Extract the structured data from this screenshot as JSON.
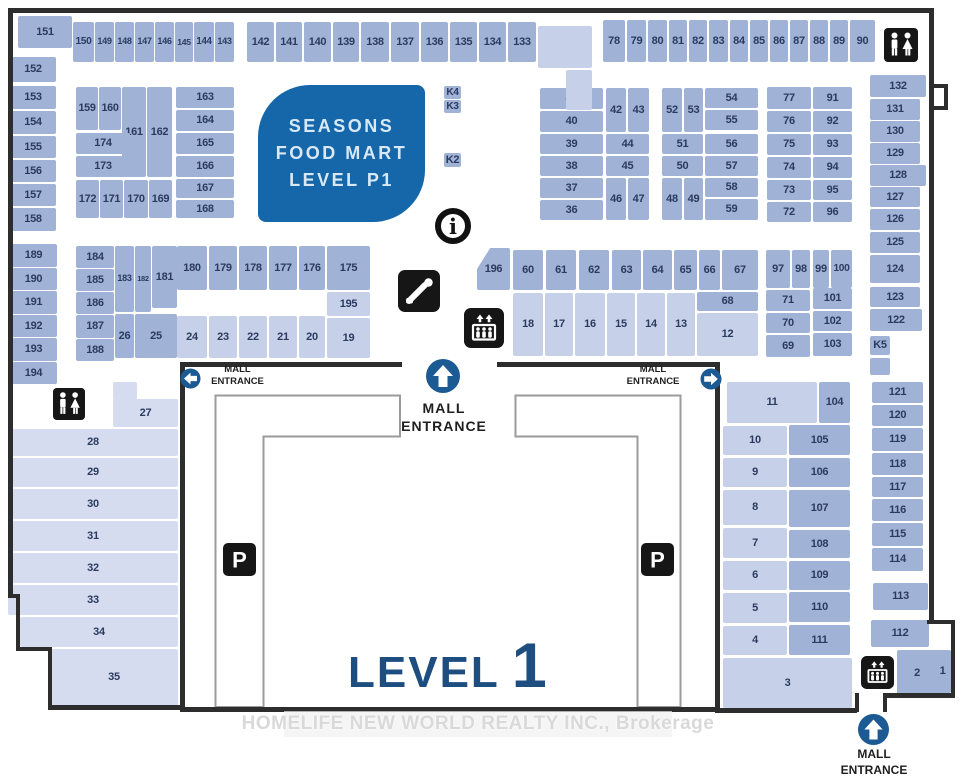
{
  "title": {
    "level_word": "LEVEL",
    "level_number": "1"
  },
  "food_mart": {
    "lines": [
      "SEASONS",
      "FOOD MART",
      "LEVEL P1"
    ]
  },
  "watermark_text": "HOMELIFE NEW WORLD REALTY INC., Brokerage",
  "entrances": {
    "left": {
      "line1": "MALL",
      "line2": "ENTRANCE",
      "arrow": "left"
    },
    "center": {
      "line1": "MALL",
      "line2": "ENTRANCE",
      "arrow": "up"
    },
    "right": {
      "line1": "MALL",
      "line2": "ENTRANCE",
      "arrow": "right"
    },
    "bottom": {
      "line1": "MALL",
      "line2": "ENTRANCE",
      "arrow": "up"
    }
  },
  "icons": [
    "restroom-icon",
    "info-icon",
    "escalator-icon",
    "elevator-icon",
    "parking-icon",
    "entrance-arrow-up-icon",
    "entrance-arrow-left-icon",
    "entrance-arrow-right-icon"
  ],
  "colors": {
    "unit_medium": "#a0b2d6",
    "unit_light": "#c7d0e9",
    "unit_lighter": "#d6dcf0",
    "wall": "#2d2d2d",
    "number_text": "#2b3b5f",
    "food_mart_bg": "#1567a9",
    "entrance_blue": "#1c5a94",
    "level_text": "#1d4e7f",
    "icon_black": "#161616"
  },
  "units": [
    [
      "151",
      18,
      16,
      54,
      32,
      "a"
    ],
    [
      "150",
      73,
      22,
      21,
      40,
      "a"
    ],
    [
      "149",
      95,
      22,
      19,
      40,
      "a"
    ],
    [
      "148",
      115,
      22,
      19,
      40,
      "a"
    ],
    [
      "147",
      135,
      22,
      19,
      40,
      "a"
    ],
    [
      "146",
      155,
      22,
      19,
      40,
      "a"
    ],
    [
      "145",
      175,
      22,
      18,
      40,
      "a"
    ],
    [
      "144",
      194,
      22,
      20,
      40,
      "a"
    ],
    [
      "143",
      215,
      22,
      19,
      40,
      "a"
    ],
    [
      "152",
      10,
      57,
      46,
      25,
      "a"
    ],
    [
      "153",
      10,
      86,
      46,
      23,
      "a"
    ],
    [
      "154",
      10,
      111,
      46,
      23,
      "a"
    ],
    [
      "155",
      10,
      136,
      46,
      22,
      "a"
    ],
    [
      "156",
      10,
      160,
      46,
      22,
      "a"
    ],
    [
      "157",
      10,
      184,
      46,
      22,
      "a"
    ],
    [
      "158",
      10,
      208,
      46,
      23,
      "a"
    ],
    [
      "159",
      76,
      87,
      22,
      43,
      "a"
    ],
    [
      "160",
      99,
      87,
      22,
      43,
      "a"
    ],
    [
      "161",
      122,
      87,
      24,
      90,
      "a"
    ],
    [
      "162",
      147,
      87,
      25,
      90,
      "a"
    ],
    [
      "174",
      76,
      133,
      54,
      21,
      "a"
    ],
    [
      "173",
      76,
      156,
      54,
      21,
      "a"
    ],
    [
      "172",
      76,
      180,
      23,
      38,
      "a"
    ],
    [
      "171",
      100,
      180,
      23,
      38,
      "a"
    ],
    [
      "170",
      124,
      180,
      24,
      38,
      "a"
    ],
    [
      "169",
      149,
      180,
      23,
      38,
      "a"
    ],
    [
      "163",
      176,
      87,
      58,
      21,
      "a"
    ],
    [
      "164",
      176,
      110,
      58,
      21,
      "a"
    ],
    [
      "165",
      176,
      133,
      58,
      21,
      "a"
    ],
    [
      "166",
      176,
      156,
      58,
      21,
      "a"
    ],
    [
      "167",
      176,
      179,
      58,
      19,
      "a"
    ],
    [
      "168",
      176,
      200,
      58,
      18,
      "a"
    ],
    [
      "142",
      247,
      22,
      27,
      40,
      "a"
    ],
    [
      "141",
      276,
      22,
      26,
      40,
      "a"
    ],
    [
      "140",
      304,
      22,
      27,
      40,
      "a"
    ],
    [
      "139",
      333,
      22,
      26,
      40,
      "a"
    ],
    [
      "138",
      361,
      22,
      28,
      40,
      "a"
    ],
    [
      "137",
      391,
      22,
      28,
      40,
      "a"
    ],
    [
      "136",
      421,
      22,
      27,
      40,
      "a"
    ],
    [
      "135",
      450,
      22,
      27,
      40,
      "a"
    ],
    [
      "134",
      479,
      22,
      27,
      40,
      "a"
    ],
    [
      "133",
      508,
      22,
      28,
      40,
      "a"
    ],
    [
      "K4",
      444,
      86,
      17,
      13,
      "a"
    ],
    [
      "K3",
      444,
      100,
      17,
      13,
      "a"
    ],
    [
      "K2",
      444,
      153,
      17,
      14,
      "a"
    ],
    [
      "78",
      603,
      20,
      22,
      42,
      "a"
    ],
    [
      "79",
      627,
      20,
      19,
      42,
      "a"
    ],
    [
      "80",
      648,
      20,
      19,
      42,
      "a"
    ],
    [
      "81",
      669,
      20,
      18,
      42,
      "a"
    ],
    [
      "82",
      689,
      20,
      18,
      42,
      "a"
    ],
    [
      "83",
      709,
      20,
      19,
      42,
      "a"
    ],
    [
      "84",
      730,
      20,
      18,
      42,
      "a"
    ],
    [
      "85",
      750,
      20,
      18,
      42,
      "a"
    ],
    [
      "86",
      770,
      20,
      18,
      42,
      "a"
    ],
    [
      "87",
      790,
      20,
      18,
      42,
      "a"
    ],
    [
      "88",
      810,
      20,
      18,
      42,
      "a"
    ],
    [
      "89",
      830,
      20,
      18,
      42,
      "a"
    ],
    [
      "90",
      850,
      20,
      25,
      42,
      "a"
    ],
    [
      "41",
      540,
      88,
      63,
      21,
      "a"
    ],
    [
      "40",
      540,
      111,
      63,
      21,
      "a"
    ],
    [
      "39",
      540,
      134,
      63,
      20,
      "a"
    ],
    [
      "38",
      540,
      156,
      63,
      20,
      "a"
    ],
    [
      "37",
      540,
      178,
      63,
      20,
      "a"
    ],
    [
      "36",
      540,
      200,
      63,
      20,
      "a"
    ],
    [
      "42",
      606,
      88,
      20,
      44,
      "a"
    ],
    [
      "43",
      628,
      88,
      21,
      44,
      "a"
    ],
    [
      "44",
      606,
      134,
      43,
      20,
      "a"
    ],
    [
      "45",
      606,
      156,
      43,
      20,
      "a"
    ],
    [
      "46",
      606,
      178,
      20,
      42,
      "a"
    ],
    [
      "47",
      628,
      178,
      21,
      42,
      "a"
    ],
    [
      "52",
      662,
      88,
      20,
      44,
      "a"
    ],
    [
      "53",
      684,
      88,
      19,
      44,
      "a"
    ],
    [
      "54",
      705,
      88,
      53,
      20,
      "a"
    ],
    [
      "55",
      705,
      110,
      53,
      20,
      "a"
    ],
    [
      "51",
      662,
      134,
      41,
      20,
      "a"
    ],
    [
      "56",
      705,
      134,
      53,
      20,
      "a"
    ],
    [
      "50",
      662,
      156,
      41,
      20,
      "a"
    ],
    [
      "57",
      705,
      156,
      53,
      20,
      "a"
    ],
    [
      "48",
      662,
      178,
      20,
      42,
      "a"
    ],
    [
      "49",
      684,
      178,
      19,
      42,
      "a"
    ],
    [
      "58",
      705,
      178,
      53,
      19,
      "a"
    ],
    [
      "59",
      705,
      199,
      53,
      21,
      "a"
    ],
    [
      "77",
      767,
      87,
      44,
      22,
      "a"
    ],
    [
      "76",
      767,
      111,
      44,
      21,
      "a"
    ],
    [
      "75",
      767,
      134,
      44,
      21,
      "a"
    ],
    [
      "74",
      767,
      157,
      44,
      21,
      "a"
    ],
    [
      "73",
      767,
      180,
      44,
      20,
      "a"
    ],
    [
      "72",
      767,
      202,
      44,
      20,
      "a"
    ],
    [
      "91",
      813,
      87,
      39,
      22,
      "a"
    ],
    [
      "92",
      813,
      111,
      39,
      21,
      "a"
    ],
    [
      "93",
      813,
      134,
      39,
      21,
      "a"
    ],
    [
      "94",
      813,
      157,
      39,
      21,
      "a"
    ],
    [
      "95",
      813,
      180,
      39,
      20,
      "a"
    ],
    [
      "96",
      813,
      202,
      39,
      20,
      "a"
    ],
    [
      "132",
      870,
      75,
      56,
      22,
      "a"
    ],
    [
      "131",
      870,
      99,
      50,
      21,
      "a"
    ],
    [
      "130",
      870,
      121,
      50,
      21,
      "a"
    ],
    [
      "129",
      870,
      143,
      50,
      21,
      "a"
    ],
    [
      "128",
      870,
      165,
      56,
      21,
      "a"
    ],
    [
      "127",
      870,
      187,
      50,
      20,
      "a"
    ],
    [
      "126",
      870,
      209,
      50,
      21,
      "a"
    ],
    [
      "125",
      870,
      232,
      50,
      21,
      "a"
    ],
    [
      "124",
      870,
      255,
      50,
      28,
      "a"
    ],
    [
      "123",
      870,
      287,
      50,
      20,
      "a"
    ],
    [
      "122",
      870,
      309,
      52,
      22,
      "a"
    ],
    [
      "K5",
      870,
      336,
      20,
      19,
      "a"
    ],
    [
      "196",
      477,
      248,
      33,
      42,
      "a"
    ],
    [
      "60",
      513,
      250,
      30,
      40,
      "a"
    ],
    [
      "61",
      546,
      250,
      30,
      40,
      "a"
    ],
    [
      "62",
      579,
      250,
      30,
      40,
      "a"
    ],
    [
      "63",
      612,
      250,
      29,
      40,
      "a"
    ],
    [
      "64",
      643,
      250,
      29,
      40,
      "a"
    ],
    [
      "65",
      674,
      250,
      23,
      40,
      "a"
    ],
    [
      "66",
      699,
      250,
      21,
      40,
      "a"
    ],
    [
      "67",
      722,
      250,
      36,
      40,
      "a"
    ],
    [
      "68",
      697,
      292,
      61,
      19,
      "a"
    ],
    [
      "18",
      513,
      293,
      30,
      63,
      "b"
    ],
    [
      "17",
      545,
      293,
      28,
      63,
      "b"
    ],
    [
      "16",
      575,
      293,
      30,
      63,
      "b"
    ],
    [
      "15",
      607,
      293,
      28,
      63,
      "b"
    ],
    [
      "14",
      637,
      293,
      28,
      63,
      "b"
    ],
    [
      "13",
      667,
      293,
      28,
      63,
      "b"
    ],
    [
      "12",
      697,
      313,
      61,
      43,
      "b"
    ],
    [
      "189",
      10,
      244,
      47,
      23,
      "a"
    ],
    [
      "190",
      10,
      268,
      47,
      22,
      "a"
    ],
    [
      "191",
      10,
      291,
      47,
      23,
      "a"
    ],
    [
      "192",
      10,
      315,
      47,
      22,
      "a"
    ],
    [
      "193",
      10,
      338,
      47,
      23,
      "a"
    ],
    [
      "194",
      10,
      362,
      47,
      22,
      "a"
    ],
    [
      "184",
      76,
      246,
      38,
      22,
      "a"
    ],
    [
      "185",
      76,
      269,
      38,
      22,
      "a"
    ],
    [
      "186",
      76,
      292,
      38,
      22,
      "a"
    ],
    [
      "187",
      76,
      315,
      38,
      23,
      "a"
    ],
    [
      "188",
      76,
      339,
      38,
      22,
      "a"
    ],
    [
      "183",
      115,
      246,
      19,
      66,
      "a"
    ],
    [
      "182",
      135,
      246,
      16,
      66,
      "a"
    ],
    [
      "181",
      152,
      246,
      25,
      62,
      "a"
    ],
    [
      "26",
      115,
      314,
      19,
      44,
      "a"
    ],
    [
      "25",
      135,
      314,
      42,
      44,
      "a"
    ],
    [
      "180",
      177,
      246,
      30,
      44,
      "a"
    ],
    [
      "179",
      209,
      246,
      28,
      44,
      "a"
    ],
    [
      "178",
      239,
      246,
      28,
      44,
      "a"
    ],
    [
      "177",
      269,
      246,
      28,
      44,
      "a"
    ],
    [
      "176",
      299,
      246,
      26,
      44,
      "a"
    ],
    [
      "175",
      327,
      246,
      43,
      44,
      "a"
    ],
    [
      "195",
      327,
      292,
      43,
      24,
      "b"
    ],
    [
      "24",
      177,
      316,
      30,
      42,
      "b"
    ],
    [
      "23",
      209,
      316,
      28,
      42,
      "b"
    ],
    [
      "22",
      239,
      316,
      28,
      42,
      "b"
    ],
    [
      "21",
      269,
      316,
      28,
      42,
      "b"
    ],
    [
      "20",
      299,
      316,
      26,
      42,
      "b"
    ],
    [
      "19",
      327,
      318,
      43,
      40,
      "b"
    ],
    [
      "27",
      113,
      399,
      65,
      28,
      "c"
    ],
    [
      "28",
      8,
      429,
      170,
      27,
      "c"
    ],
    [
      "29",
      8,
      458,
      170,
      29,
      "c"
    ],
    [
      "30",
      8,
      489,
      170,
      30,
      "c"
    ],
    [
      "31",
      8,
      521,
      170,
      30,
      "c"
    ],
    [
      "32",
      8,
      553,
      170,
      30,
      "c"
    ],
    [
      "33",
      8,
      585,
      170,
      30,
      "c"
    ],
    [
      "34",
      20,
      617,
      158,
      30,
      "c"
    ],
    [
      "35",
      50,
      649,
      128,
      57,
      "c"
    ],
    [
      "97",
      766,
      250,
      24,
      38,
      "a"
    ],
    [
      "98",
      792,
      250,
      18,
      38,
      "a"
    ],
    [
      "99",
      813,
      250,
      16,
      38,
      "a"
    ],
    [
      "100",
      831,
      250,
      21,
      38,
      "a"
    ],
    [
      "71",
      766,
      290,
      44,
      21,
      "a"
    ],
    [
      "101",
      813,
      288,
      39,
      21,
      "a"
    ],
    [
      "70",
      766,
      313,
      44,
      20,
      "a"
    ],
    [
      "102",
      813,
      311,
      39,
      20,
      "a"
    ],
    [
      "69",
      766,
      335,
      44,
      22,
      "a"
    ],
    [
      "103",
      813,
      333,
      39,
      23,
      "a"
    ],
    [
      "11",
      727,
      382,
      90,
      41,
      "b"
    ],
    [
      "104",
      819,
      382,
      31,
      41,
      "a"
    ],
    [
      "10",
      723,
      426,
      64,
      29,
      "b"
    ],
    [
      "105",
      789,
      425,
      61,
      30,
      "a"
    ],
    [
      "9",
      723,
      458,
      64,
      29,
      "b"
    ],
    [
      "106",
      789,
      458,
      61,
      29,
      "a"
    ],
    [
      "8",
      723,
      490,
      64,
      35,
      "b"
    ],
    [
      "107",
      789,
      490,
      61,
      37,
      "a"
    ],
    [
      "7",
      723,
      528,
      64,
      30,
      "b"
    ],
    [
      "108",
      789,
      530,
      61,
      28,
      "a"
    ],
    [
      "6",
      723,
      561,
      64,
      29,
      "b"
    ],
    [
      "109",
      789,
      561,
      61,
      29,
      "a"
    ],
    [
      "5",
      723,
      593,
      64,
      30,
      "b"
    ],
    [
      "110",
      789,
      592,
      61,
      30,
      "a"
    ],
    [
      "4",
      723,
      626,
      64,
      29,
      "b"
    ],
    [
      "111",
      789,
      625,
      61,
      30,
      "a"
    ],
    [
      "3",
      723,
      658,
      129,
      50,
      "b"
    ],
    [
      "121",
      872,
      382,
      51,
      21,
      "a"
    ],
    [
      "120",
      872,
      405,
      51,
      21,
      "a"
    ],
    [
      "119",
      872,
      428,
      51,
      23,
      "a"
    ],
    [
      "118",
      872,
      453,
      51,
      22,
      "a"
    ],
    [
      "117",
      872,
      477,
      51,
      20,
      "a"
    ],
    [
      "116",
      872,
      499,
      51,
      22,
      "a"
    ],
    [
      "115",
      872,
      523,
      51,
      23,
      "a"
    ],
    [
      "114",
      872,
      548,
      51,
      23,
      "a"
    ],
    [
      "113",
      873,
      583,
      55,
      27,
      "a"
    ],
    [
      "112",
      871,
      620,
      58,
      27,
      "a"
    ],
    [
      "2",
      897,
      650,
      40,
      47,
      "a"
    ],
    [
      "1",
      934,
      650,
      17,
      43,
      "a"
    ]
  ],
  "unlabeled_areas": [
    [
      538,
      26,
      54,
      42,
      "b"
    ],
    [
      566,
      70,
      26,
      40,
      "b"
    ],
    [
      870,
      358,
      20,
      17,
      "a"
    ],
    [
      113,
      382,
      24,
      18,
      "c"
    ]
  ]
}
